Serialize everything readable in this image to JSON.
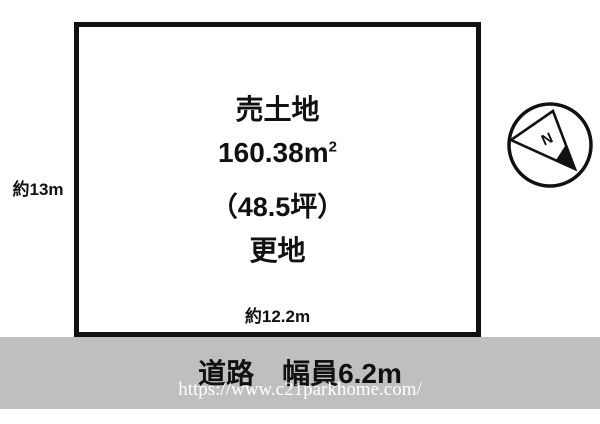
{
  "diagram": {
    "plot": {
      "title": "売土地",
      "area_m2_main": "160.38m",
      "area_m2_sup": "2",
      "area_tsubo": "（48.5坪）",
      "condition": "更地",
      "frontage_label": "約12.2m",
      "depth_label": "約13m"
    },
    "road": {
      "label": "道路　幅員6.2m"
    },
    "compass": {
      "letter": "N"
    },
    "watermark": {
      "url": "https://www.c21parkhome.com/"
    },
    "colors": {
      "outline": "#111111",
      "road_band": "#bfbfbf",
      "watermark_text": "#ffffff",
      "background": "#ffffff"
    }
  }
}
